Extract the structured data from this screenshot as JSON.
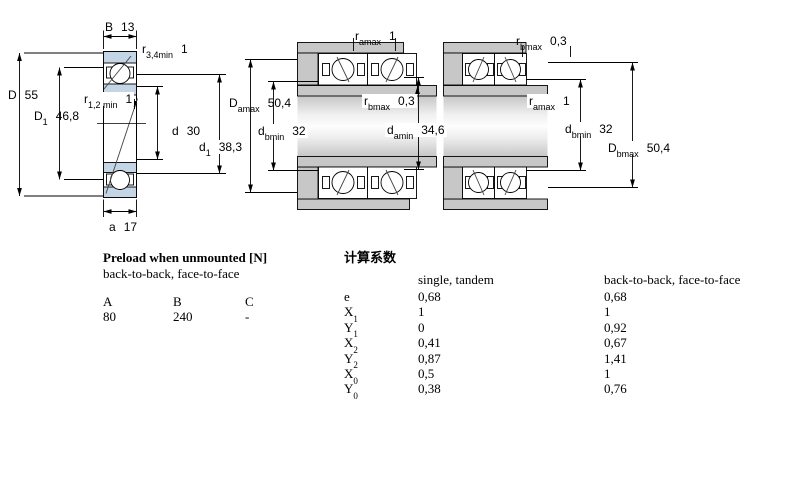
{
  "colors": {
    "ring_blue": "#c4d6e5",
    "housing_grey": "#c7c7c7",
    "line_black": "#000000",
    "page_bg": "#ffffff"
  },
  "diagram_single": {
    "name": "single bearing cross-section",
    "dims": {
      "B": {
        "main": "B",
        "sub": "",
        "value": "13"
      },
      "r34": {
        "main": "r",
        "sub": "3,4min",
        "value": "1"
      },
      "D": {
        "main": "D",
        "sub": "",
        "value": "55"
      },
      "D1": {
        "main": "D",
        "sub": "1",
        "value": "46,8"
      },
      "r12": {
        "main": "r",
        "sub": "1,2 min",
        "value": "1"
      },
      "d": {
        "main": "d",
        "sub": "",
        "value": "30"
      },
      "d1": {
        "main": "d",
        "sub": "1",
        "value": "38,3"
      },
      "a": {
        "main": "a",
        "sub": "",
        "value": "17"
      }
    }
  },
  "diagram_pair_left": {
    "name": "paired arrangement - abutment dimensions (a side)",
    "dims": {
      "ramax": {
        "main": "r",
        "sub": "amax",
        "value": "1"
      },
      "Damax": {
        "main": "D",
        "sub": "amax",
        "value": "50,4"
      },
      "rbmax": {
        "main": "r",
        "sub": "bmax",
        "value": "0,3"
      },
      "dbmin": {
        "main": "d",
        "sub": "bmin",
        "value": "32"
      },
      "damin": {
        "main": "d",
        "sub": "amin",
        "value": "34,6"
      }
    }
  },
  "diagram_pair_right": {
    "name": "paired arrangement - abutment dimensions (b side)",
    "dims": {
      "rbmax": {
        "main": "r",
        "sub": "bmax",
        "value": "0,3"
      },
      "ramax": {
        "main": "r",
        "sub": "amax",
        "value": "1"
      },
      "dbmin": {
        "main": "d",
        "sub": "bmin",
        "value": "32"
      },
      "Dbmax": {
        "main": "D",
        "sub": "bmax",
        "value": "50,4"
      }
    }
  },
  "preload_table": {
    "title": "Preload when unmounted [N]",
    "subtitle": "back-to-back, face-to-face",
    "columns": [
      "A",
      "B",
      "C"
    ],
    "values": [
      "80",
      "240",
      "-"
    ]
  },
  "factors_table": {
    "title": "计算系数",
    "col1_header": "single, tandem",
    "col2_header": "back-to-back, face-to-face",
    "rows": [
      {
        "label": "e",
        "sub": "",
        "single_tandem": "0,68",
        "btb_ftf": "0,68"
      },
      {
        "label": "X",
        "sub": "1",
        "single_tandem": "1",
        "btb_ftf": "1"
      },
      {
        "label": "Y",
        "sub": "1",
        "single_tandem": "0",
        "btb_ftf": "0,92"
      },
      {
        "label": "X",
        "sub": "2",
        "single_tandem": "0,41",
        "btb_ftf": "0,67"
      },
      {
        "label": "Y",
        "sub": "2",
        "single_tandem": "0,87",
        "btb_ftf": "1,41"
      },
      {
        "label": "X",
        "sub": "0",
        "single_tandem": "0,5",
        "btb_ftf": "1"
      },
      {
        "label": "Y",
        "sub": "0",
        "single_tandem": "0,38",
        "btb_ftf": "0,76"
      }
    ]
  }
}
